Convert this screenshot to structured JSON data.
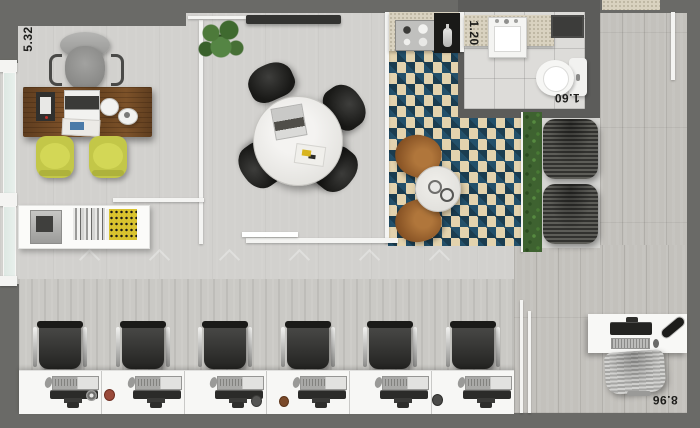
{
  "labels": {
    "dim_office_width": "5.32",
    "dim_kitchen": "1.20",
    "dim_bathroom": "1.60",
    "dim_openspace": "8.96"
  },
  "palette": {
    "wall_gray": "#6a6a67",
    "wall_dark_gray": "#5c5c5a",
    "partition_white": "#f4f4f2",
    "floor_concrete": "#d2d1ce",
    "floor_wood": "#c3c1bc",
    "bath_tile": "#dddcd9",
    "rug_cream": "#e3d3ae",
    "rug_teal": "#23506a",
    "rug_navy": "#1b3d50",
    "counter_granite": "#d9d2c0",
    "hedge_green": "#3e6230",
    "chair_yellow": "#c3c748",
    "desk_wood_brown": "#6e4724",
    "dark_furniture": "#232321"
  }
}
